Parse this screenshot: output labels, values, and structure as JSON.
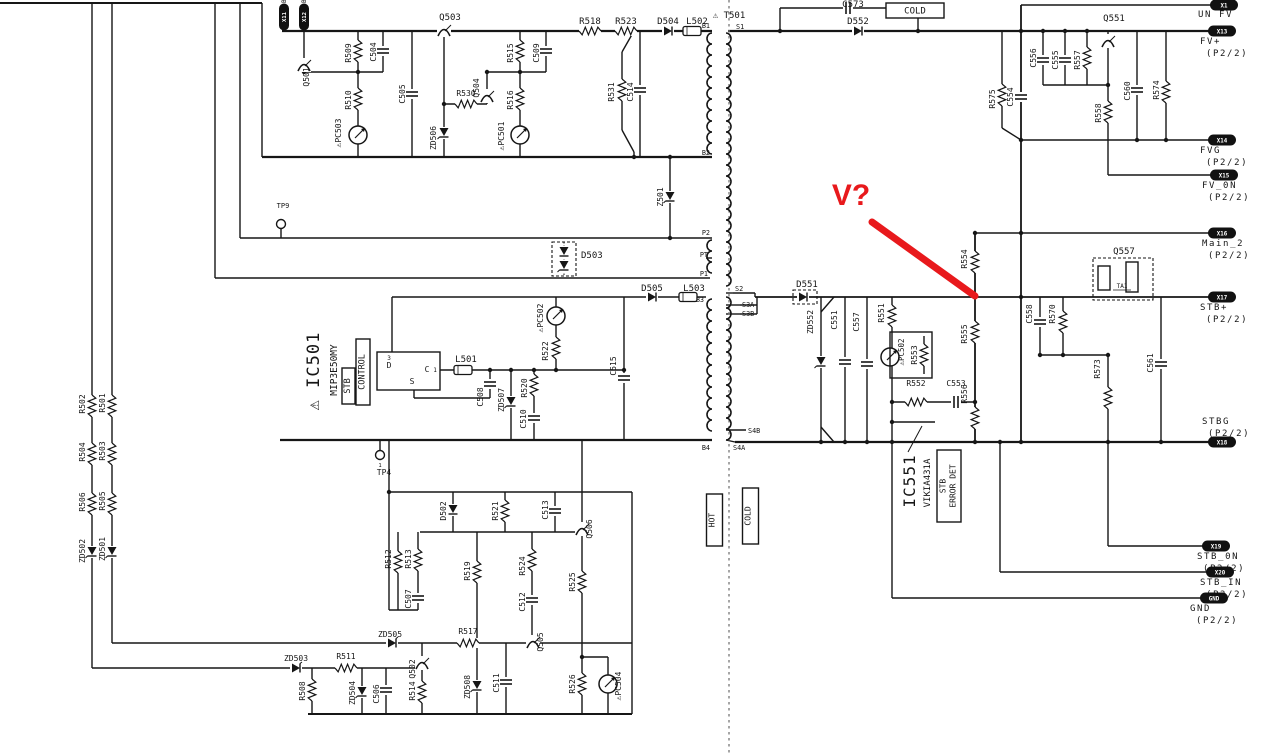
{
  "annotation": {
    "text": "V?",
    "color": "#e8191c"
  },
  "colors": {
    "wire": "#161616",
    "background": "#ffffff"
  },
  "schematic": {
    "components": [
      {
        "id": "q501",
        "label": "Q501"
      },
      {
        "id": "r509",
        "label": "R509"
      },
      {
        "id": "c504",
        "label": "C504"
      },
      {
        "id": "r510",
        "label": "R510"
      },
      {
        "id": "pc503",
        "label": "⚠PC503"
      },
      {
        "id": "c505",
        "label": "C505"
      },
      {
        "id": "q503",
        "label": "Q503"
      },
      {
        "id": "zd506",
        "label": "ZD506"
      },
      {
        "id": "r530",
        "label": "R530"
      },
      {
        "id": "q504",
        "label": "Q504"
      },
      {
        "id": "r515",
        "label": "R515"
      },
      {
        "id": "c509",
        "label": "C509"
      },
      {
        "id": "r516",
        "label": "R516"
      },
      {
        "id": "pc501",
        "label": "⚠PC501"
      },
      {
        "id": "r518",
        "label": "R518"
      },
      {
        "id": "r523",
        "label": "R523"
      },
      {
        "id": "d504",
        "label": "D504"
      },
      {
        "id": "l502",
        "label": "L502"
      },
      {
        "id": "t501",
        "label": "⚠ T501"
      },
      {
        "id": "r531",
        "label": "R531"
      },
      {
        "id": "c514",
        "label": "C514"
      },
      {
        "id": "z501",
        "label": "Z501"
      },
      {
        "id": "c573",
        "label": "C573"
      },
      {
        "id": "d552",
        "label": "D552"
      },
      {
        "id": "q551",
        "label": "Q551"
      },
      {
        "id": "r575",
        "label": "R575"
      },
      {
        "id": "c554",
        "label": "C554"
      },
      {
        "id": "c556",
        "label": "C556"
      },
      {
        "id": "c555",
        "label": "C555"
      },
      {
        "id": "r557",
        "label": "R557"
      },
      {
        "id": "r558",
        "label": "R558"
      },
      {
        "id": "c560",
        "label": "C560"
      },
      {
        "id": "r574",
        "label": "R574"
      },
      {
        "id": "r554",
        "label": "R554"
      },
      {
        "id": "r555",
        "label": "R555"
      },
      {
        "id": "r556",
        "label": "R556"
      },
      {
        "id": "q557",
        "label": "Q557"
      },
      {
        "id": "ta1",
        "label": "TA1"
      },
      {
        "id": "c558",
        "label": "C558"
      },
      {
        "id": "r570",
        "label": "R570"
      },
      {
        "id": "r573",
        "label": "R573"
      },
      {
        "id": "c561",
        "label": "C561"
      },
      {
        "id": "zd552",
        "label": "ZD552"
      },
      {
        "id": "c551",
        "label": "C551"
      },
      {
        "id": "c557",
        "label": "C557"
      },
      {
        "id": "r551",
        "label": "R551"
      },
      {
        "id": "pc502b",
        "label": "⚠PC502"
      },
      {
        "id": "r553",
        "label": "R553"
      },
      {
        "id": "r552",
        "label": "R552"
      },
      {
        "id": "c553",
        "label": "C553"
      },
      {
        "id": "ic551",
        "label": "IC551"
      },
      {
        "id": "vikia",
        "label": "VIKIA431A"
      },
      {
        "id": "d503",
        "label": "D503"
      },
      {
        "id": "d505",
        "label": "D505"
      },
      {
        "id": "l503",
        "label": "L503"
      },
      {
        "id": "d551",
        "label": "D551"
      },
      {
        "id": "pc502a",
        "label": "⚠PC502"
      },
      {
        "id": "r522",
        "label": "R522"
      },
      {
        "id": "ic501",
        "label": "⚠ IC501"
      },
      {
        "id": "mip",
        "label": "MIP3E50MY"
      },
      {
        "id": "pin3",
        "label": "3"
      },
      {
        "id": "pinD",
        "label": "D"
      },
      {
        "id": "pinS",
        "label": "S"
      },
      {
        "id": "pinC",
        "label": "C"
      },
      {
        "id": "pin1",
        "label": "1"
      },
      {
        "id": "l501",
        "label": "L501"
      },
      {
        "id": "c508",
        "label": "C508"
      },
      {
        "id": "zd507",
        "label": "ZD507"
      },
      {
        "id": "r520",
        "label": "R520"
      },
      {
        "id": "c510",
        "label": "C510"
      },
      {
        "id": "c515",
        "label": "C515"
      },
      {
        "id": "tp9",
        "label": "TP9"
      },
      {
        "id": "tp4",
        "label": "TP4"
      },
      {
        "id": "tp4n",
        "label": "1"
      },
      {
        "id": "r502",
        "label": "R502"
      },
      {
        "id": "r501",
        "label": "R501"
      },
      {
        "id": "r504",
        "label": "R504"
      },
      {
        "id": "r503",
        "label": "R503"
      },
      {
        "id": "r506",
        "label": "R506"
      },
      {
        "id": "r505",
        "label": "R505"
      },
      {
        "id": "zd502",
        "label": "ZD502"
      },
      {
        "id": "zd501",
        "label": "ZD501"
      },
      {
        "id": "d502",
        "label": "D502"
      },
      {
        "id": "r521",
        "label": "R521"
      },
      {
        "id": "c513",
        "label": "C513"
      },
      {
        "id": "q506",
        "label": "Q506"
      },
      {
        "id": "r512",
        "label": "R512"
      },
      {
        "id": "r513",
        "label": "R513"
      },
      {
        "id": "c507",
        "label": "C507"
      },
      {
        "id": "r519",
        "label": "R519"
      },
      {
        "id": "r524",
        "label": "R524"
      },
      {
        "id": "c512",
        "label": "C512"
      },
      {
        "id": "r525",
        "label": "R525"
      },
      {
        "id": "zd505",
        "label": "ZD505"
      },
      {
        "id": "r517",
        "label": "R517"
      },
      {
        "id": "zd503",
        "label": "ZD503"
      },
      {
        "id": "r511",
        "label": "R511"
      },
      {
        "id": "q502",
        "label": "Q502"
      },
      {
        "id": "r514",
        "label": "R514"
      },
      {
        "id": "zd508",
        "label": "ZD508"
      },
      {
        "id": "c511",
        "label": "C511"
      },
      {
        "id": "q505",
        "label": "Q505"
      },
      {
        "id": "r508",
        "label": "R508"
      },
      {
        "id": "zd504",
        "label": "ZD504"
      },
      {
        "id": "c506",
        "label": "C506"
      },
      {
        "id": "r526",
        "label": "R526"
      },
      {
        "id": "pc504",
        "label": "⚠PC504"
      }
    ],
    "ic_functions": {
      "ic501_part": "MIP3E50MY",
      "ic501_function": "STB CONTROL",
      "ic551_part": "VIKIA431A",
      "ic551_function": "STB ERROR DET"
    },
    "transformer": {
      "ref": "T501",
      "taps": [
        {
          "id": "b1",
          "label": "B1"
        },
        {
          "id": "s1",
          "label": "S1"
        },
        {
          "id": "b2",
          "label": "B2"
        },
        {
          "id": "p2",
          "label": "P2"
        },
        {
          "id": "pt",
          "label": "PT"
        },
        {
          "id": "p1",
          "label": "P1"
        },
        {
          "id": "b3",
          "label": "B3"
        },
        {
          "id": "s2",
          "label": "S2"
        },
        {
          "id": "s3a",
          "label": "S3A"
        },
        {
          "id": "s3b",
          "label": "S3B"
        },
        {
          "id": "s4b",
          "label": "S4B"
        },
        {
          "id": "s4a",
          "label": "S4A"
        },
        {
          "id": "b4",
          "label": "B4"
        }
      ]
    },
    "boxed_labels": [
      {
        "id": "cold_top",
        "text": "COLD"
      },
      {
        "id": "hot",
        "text": "HOT"
      },
      {
        "id": "cold_mid",
        "text": "COLD"
      },
      {
        "id": "stbc1",
        "text": "STB"
      },
      {
        "id": "stbc2",
        "text": "CONTROL"
      },
      {
        "id": "stbe1",
        "text": "STB"
      },
      {
        "id": "stbe2",
        "text": "ERROR DET"
      }
    ],
    "connectors_right": [
      {
        "id": "X1",
        "name": "UN FV",
        "detail": ""
      },
      {
        "id": "X13",
        "name": "FV+",
        "detail": "(P2/2)"
      },
      {
        "id": "X14",
        "name": "FVG",
        "detail": "(P2/2)"
      },
      {
        "id": "X15",
        "name": "FV_0N",
        "detail": "(P2/2)"
      },
      {
        "id": "X16",
        "name": "Main_2",
        "detail": "(P2/2)"
      },
      {
        "id": "X17",
        "name": "STB+",
        "detail": "(P2/2)"
      },
      {
        "id": "X18",
        "name": "STBG",
        "detail": "(P2/2)"
      },
      {
        "id": "X19",
        "name": "STB_0N",
        "detail": "(P2/2)"
      },
      {
        "id": "X20",
        "name": "STB_IN",
        "detail": "(P2/2)"
      },
      {
        "id": "GND",
        "name": "GND",
        "detail": "(P2/2)"
      }
    ],
    "connectors_top": [
      {
        "id": "X11",
        "pin": "B"
      },
      {
        "id": "X12",
        "pin": "B"
      }
    ]
  }
}
